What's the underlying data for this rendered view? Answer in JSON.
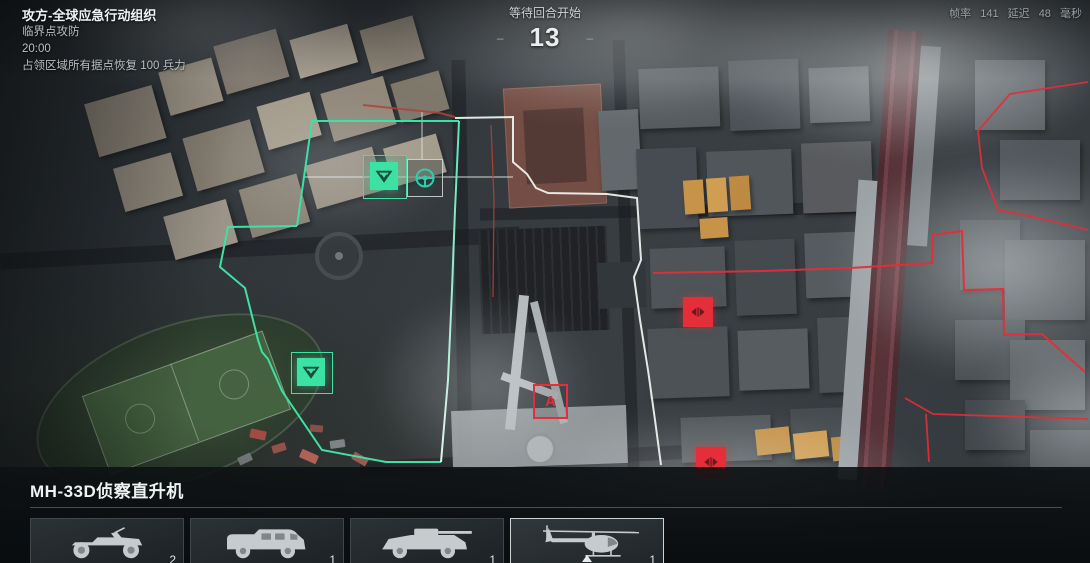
{
  "hud": {
    "faction_line": "攻方-全球应急行动组织",
    "mode_line": "临界点攻防",
    "timer": "20:00",
    "rule_line": "占领区域所有据点恢复 100 兵力",
    "round_status": "等待回合开始",
    "countdown": "13",
    "dash": "–",
    "perf": {
      "fps_label": "帧率",
      "fps_value": "141",
      "ping_label": "延迟",
      "ping_value": "48",
      "ping_unit": "毫秒"
    }
  },
  "map": {
    "objective_a_label": "A",
    "colors": {
      "friendly": "#35e3a1",
      "enemy": "#e52531",
      "frontline": "#f0f2ef",
      "spawn_icon": "#25cfae"
    }
  },
  "panel": {
    "title": "MH-33D侦察直升机",
    "vehicles": [
      {
        "icon": "quad-bike-icon",
        "count": "2"
      },
      {
        "icon": "armored-truck-icon",
        "count": "1"
      },
      {
        "icon": "armored-scout-car-icon",
        "count": "1"
      },
      {
        "icon": "scout-helicopter-icon",
        "count": "1",
        "selected": true
      }
    ]
  }
}
